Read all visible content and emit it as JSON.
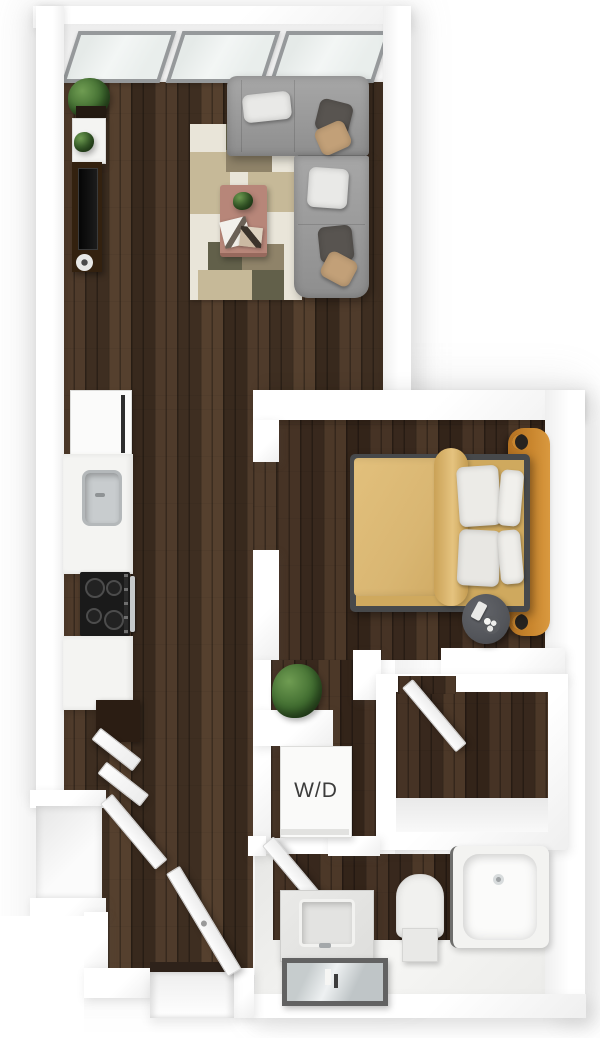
{
  "floorplan": {
    "title": "One-bedroom apartment 3D top-down floor plan",
    "labels": {
      "washer_dryer": "W/D"
    },
    "windows": 3,
    "rooms": [
      {
        "name": "living-room",
        "furniture": [
          "sectional-sofa",
          "throw-pillows",
          "area-rug",
          "coffee-table",
          "tv-console",
          "console-shelf",
          "corner-plant"
        ]
      },
      {
        "name": "kitchen",
        "furniture": [
          "refrigerator",
          "counter",
          "sink",
          "cooktop",
          "base-cabinet"
        ]
      },
      {
        "name": "bedroom",
        "furniture": [
          "bed",
          "duvet",
          "pillows",
          "headboard",
          "nightstand"
        ]
      },
      {
        "name": "hall",
        "furniture": [
          "floor-plant",
          "washer-dryer-unit"
        ]
      },
      {
        "name": "walk-in-closet",
        "furniture": [
          "open-door"
        ]
      },
      {
        "name": "bathroom",
        "furniture": [
          "vanity-sink",
          "mirror",
          "toilet",
          "bathtub",
          "open-door"
        ]
      },
      {
        "name": "entry",
        "furniture": [
          "entry-door",
          "coat-closet",
          "closet-door"
        ]
      }
    ],
    "colors": {
      "wood_base": "#46342a",
      "wall_white": "#ffffff",
      "wall_shade": "#efefef",
      "glass": "#e9eeec",
      "frame_gray": "#96999b",
      "sofa_gray": "#9c9c9c",
      "pillow_white": "#e9e9e7",
      "pillow_dark": "#585450",
      "pillow_tan": "#c2a078",
      "rug_cream": "#e9e5d9",
      "rug_tan": "#c6b998",
      "rug_olive": "#62604a",
      "rug_brown": "#8f8369",
      "table_mauve": "#b78679",
      "plant_green": "#3f6b2f",
      "tv_brown": "#33210f",
      "appliance_black": "#1a1a1a",
      "steel": "#c6c9ca",
      "duvet_tan": "#d9b672",
      "bed_frame": "#47494b",
      "headboard_orange": "#c9862e",
      "nightstand_gray": "#53555a",
      "fixture_white": "#f4f4f2",
      "mirror_frame": "#626262",
      "mirror_glass": "#c6cccd",
      "label_dark": "#3c3c3c"
    }
  }
}
